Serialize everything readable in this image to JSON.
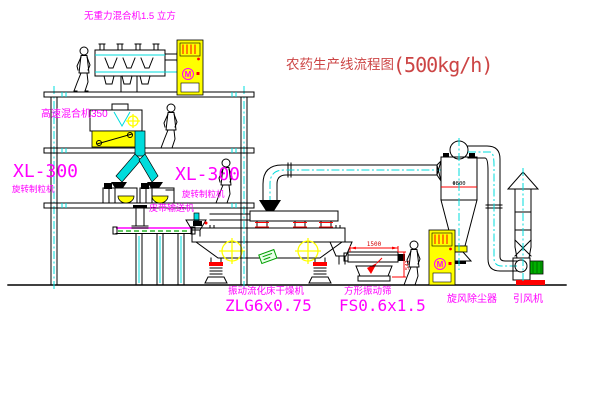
{
  "title": {
    "name_cn": "农药生产线流程图",
    "capacity": "(500kg/h)"
  },
  "labels": {
    "gravity_mixer": "无重力混合机1.5 立方",
    "high_speed_mixer": "高速混合机350",
    "granulator_left_model": "XL-300",
    "granulator_left_name": "旋转制粒机",
    "granulator_right_model": "XL-300",
    "granulator_right_name": "旋转制粒机",
    "belt_conveyor": "皮带输送机",
    "dryer_name": "振动流化床干燥机",
    "dryer_model": "ZLG6x0.75",
    "sieve_name": "方形振动筛",
    "sieve_model": "FS0.6x1.5",
    "cyclone_name": "旋风除尘器",
    "fan_name": "引风机"
  },
  "annotations": {
    "cyclone_diameter": "Φ800",
    "sieve_length": "1500",
    "sieve_height": "541",
    "motor_symbol": "M"
  },
  "colors": {
    "label_magenta": "#ff00ff",
    "title_red": "#cc4545",
    "centerline_cyan": "#00dcdc",
    "equipment_yellow": "#ffff00",
    "dimension_red": "#ff0000",
    "accent_green": "#00a000",
    "line_black": "#000000",
    "background": "#ffffff"
  }
}
